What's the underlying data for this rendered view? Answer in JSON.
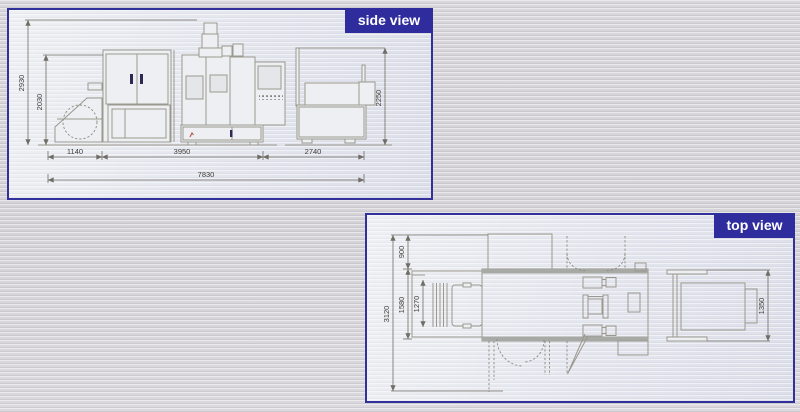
{
  "side_view": {
    "label": "side view",
    "dimensions": {
      "total_height": "2930",
      "cabinet_height": "2030",
      "right_unit_height": "2250",
      "left_width": "1140",
      "center_width": "3950",
      "right_width": "2740",
      "total_width": "7830"
    }
  },
  "top_view": {
    "label": "top view",
    "dimensions": {
      "total_depth": "3120",
      "rear_depth": "900",
      "body_depth": "1580",
      "inner_depth": "1270",
      "right_unit_depth": "1350"
    }
  },
  "colors": {
    "panel_border": "#32309b",
    "label_background": "#2f2d9e",
    "label_text": "#ffffff",
    "drawing_line": "#9b988f",
    "dimension_line": "#6f6d66",
    "dimension_text": "#3f3d38",
    "page_background": "#d7d5d9",
    "panel_background": "#e7e9ee"
  }
}
